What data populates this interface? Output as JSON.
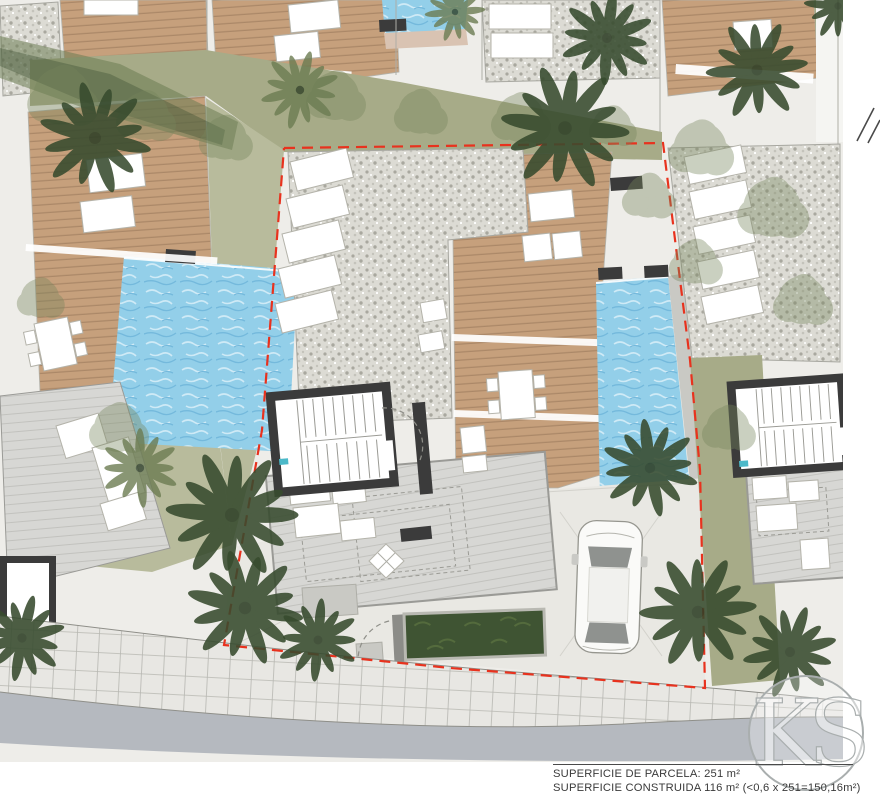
{
  "meta": {
    "type": "architectural-site-plan"
  },
  "annotations": {
    "parcel_area_line": "SUPERFICIE DE PARCELA: 251 m²",
    "built_area_line": "SUPERFICIE CONSTRUIDA 116 m² (<0,6 x 251=150,16m²)"
  },
  "values": {
    "parcel_area_m2": 251,
    "built_area_m2": 116,
    "max_buildable_formula": "<0,6 x 251=150,16m²"
  },
  "watermark": {
    "text": "KS"
  },
  "palette": {
    "paving": "#eeede9",
    "paving2": "#e9e8e3",
    "deck": "#c6a07c",
    "deckLine": "#ab8868",
    "deckEdge": "#d9c3b2",
    "pool": "#93cfe9",
    "poolLight": "#cfeaf6",
    "poolDark": "#74b9dc",
    "gravel": "#dcdbd4",
    "gravelDot": "#a9a89f",
    "grass": "#a7ab88",
    "grassLight": "#b8bb9c",
    "canopy": "#76855c",
    "treeDark": "#374b2e",
    "treeOlive": "#6c7c52",
    "wall": "#3b3b3b",
    "walk": "#c9c9c4",
    "terrace": "#d7d7d4",
    "terraceLine": "#c2c2be",
    "road": "#b5b9bf",
    "sidewalk": "#e8e7e3",
    "sidewalkLine": "#b7b7b1",
    "boundary": "#e8321e",
    "furnitureStroke": "#b4b3aa",
    "dashStroke": "#9b9b95",
    "thinLine": "#aeaea7",
    "carGlass": "#8f928f",
    "text": "#3a3a3a",
    "watermark": "#a9aeae",
    "teal": "#4cb9c9"
  }
}
